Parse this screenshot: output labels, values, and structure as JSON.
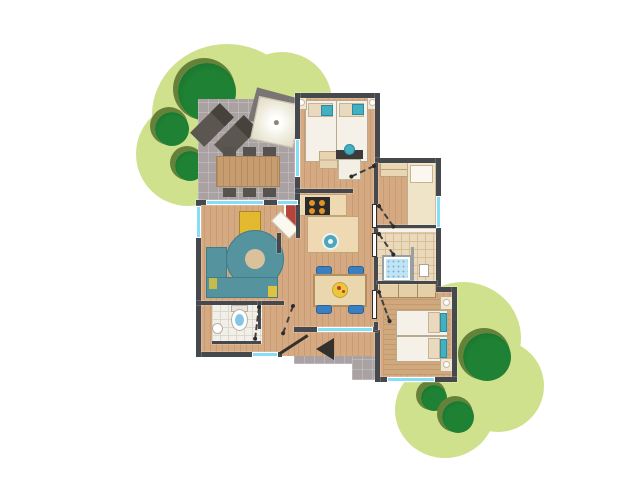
{
  "palette": {
    "background": "#ffffff",
    "garden": "#cfe18d",
    "tree": "#1f8133",
    "tree_dark": "#14662a",
    "tree_shadow": "#66823a",
    "terrace": "#aaa2a2",
    "wall": "#45494d",
    "wood": "#d5aa82",
    "wood_stripe": "#c89d76",
    "deck": "#d0a87d",
    "deck_stripe": "#c3996e",
    "tile_beige": "#ead9bb",
    "tile_beige_line": "#d6bf97",
    "tile_white": "#f2efe9",
    "tile_white_line": "#ddd8cd",
    "window": "#88ddf6",
    "teal": "#55939f",
    "teal_dark": "#3e7d8a",
    "accent_teal": "#43b0c2",
    "yellow": "#e2b92f",
    "yellow_dark": "#a8871f",
    "red": "#b5453a",
    "blue": "#3c7fbf",
    "bed": "#f6f1e8",
    "bed_border": "#b9a98e",
    "linen": "#e9d9bf",
    "counter": "#eed9b2",
    "counter_border": "#c2a577",
    "stove": "#2b2b2b",
    "burner": "#e09327",
    "gray_dark": "#56524d",
    "parasol": "#f3f0e1",
    "plate": "#e9c83e",
    "water": "#86c6e4",
    "shower": "#bfe4f4",
    "door": "#34302b"
  },
  "plan": {
    "type": "holiday-cottage-floor-plan",
    "areas": [
      {
        "name": "terrace",
        "items": [
          "sun-lounger",
          "sun-lounger",
          "parasol",
          "outdoor-dining-table",
          "6-chairs"
        ]
      },
      {
        "name": "living-room",
        "items": [
          "corner-sofa",
          "round-rug",
          "armchair",
          "fireplace-stove"
        ]
      },
      {
        "name": "kitchen",
        "items": [
          "hob-4-burners",
          "worktop",
          "round-sink",
          "corner-cupboard"
        ]
      },
      {
        "name": "dining-area",
        "items": [
          "dining-table",
          "4-chairs",
          "plate-with-food"
        ]
      },
      {
        "name": "master-bedroom",
        "items": [
          "double-bed",
          "2-nightstands",
          "2-lamps",
          "washbasin-vanity",
          "stool"
        ]
      },
      {
        "name": "second-bedroom",
        "items": [
          "single-bed",
          "dresser"
        ]
      },
      {
        "name": "bathroom",
        "items": [
          "shower",
          "washbasin"
        ]
      },
      {
        "name": "toilet-room",
        "items": [
          "toilet",
          "hand-basin"
        ]
      },
      {
        "name": "third-bedroom",
        "items": [
          "twin-beds",
          "2-nightstands",
          "2-lamps",
          "wardrobe",
          "deck-rug"
        ]
      },
      {
        "name": "hallway",
        "items": []
      },
      {
        "name": "entrance",
        "items": [
          "entrance-door",
          "direction-arrow"
        ]
      }
    ],
    "garden": {
      "bushes": 2,
      "trees": 6
    },
    "windows": 8,
    "interior_door_swings": 6
  }
}
